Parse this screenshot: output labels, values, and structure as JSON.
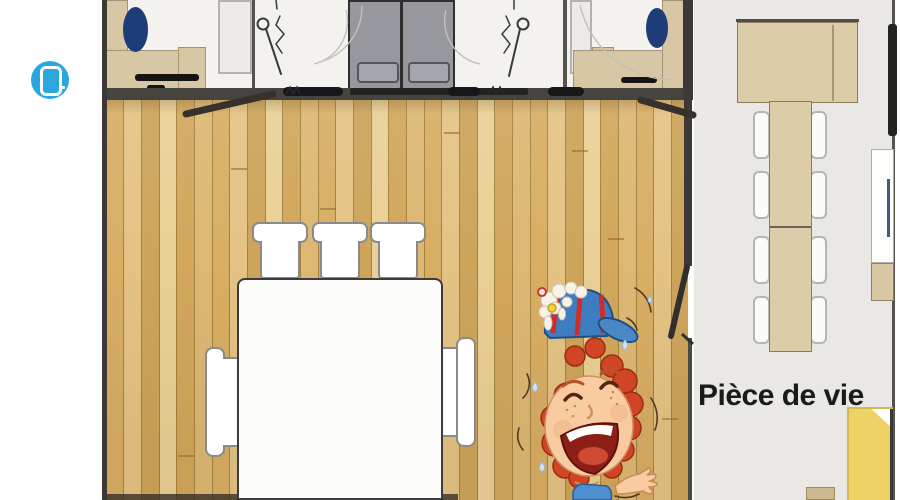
{
  "overlay": {
    "gallery_button": {
      "icon": "tablet-icon",
      "color": "#2ba7e0"
    }
  },
  "plan": {
    "living_room_label": "Pièce de vie",
    "colors": {
      "wood_floor": "#ddb873",
      "wall_dark": "#45443f",
      "room_floor_white": "#f3f2ef",
      "living_floor_gray": "#e9e8e5",
      "furniture_tan": "#d8c7a4",
      "table_wood": "#dcccA7",
      "pillow_navy": "#1e3d78",
      "sofa_yellow": "#efd266",
      "wardrobe_door_gray": "#97989d",
      "icon_blue": "#2ba7e0"
    }
  }
}
